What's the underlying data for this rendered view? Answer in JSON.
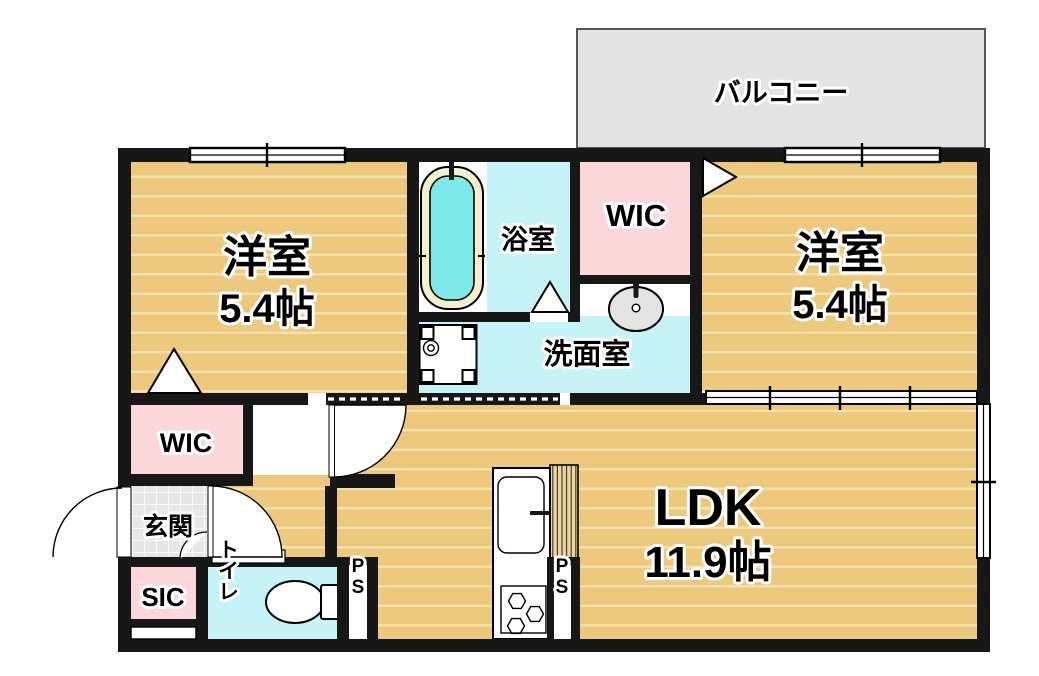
{
  "plan_title": "1LDK-floor-plan",
  "colors": {
    "wall": "#171717",
    "wood": "#ecc97d",
    "wood_stripe": "#f6e0ab",
    "wet": "#c6f3f5",
    "pink": "#fbd7da",
    "balcony": "#e3e3e3",
    "tile": "#e7e7e7",
    "tub_water": "#7de9e9",
    "tub_rim": "#f5efcd",
    "hatch": "#e8d8a4",
    "sink_fill": "#e4e4e4"
  },
  "rooms": {
    "balcony": {
      "label": "バルコニー"
    },
    "bedroom_left": {
      "label": "洋室",
      "size": "5.4帖"
    },
    "bedroom_right": {
      "label": "洋室",
      "size": "5.4帖"
    },
    "bathroom": {
      "label": "浴室"
    },
    "wic_top": {
      "label": "WIC"
    },
    "wic_left": {
      "label": "WIC"
    },
    "washroom": {
      "label": "洗面室"
    },
    "ldk": {
      "label": "LDK",
      "size": "11.9帖"
    },
    "entrance": {
      "label": "玄関"
    },
    "sic": {
      "label": "SIC"
    },
    "toilet": {
      "label": "トイレ"
    },
    "pipe_shaft_toilet": {
      "label": "PS"
    },
    "pipe_shaft_kitchen": {
      "label": "PS"
    }
  }
}
